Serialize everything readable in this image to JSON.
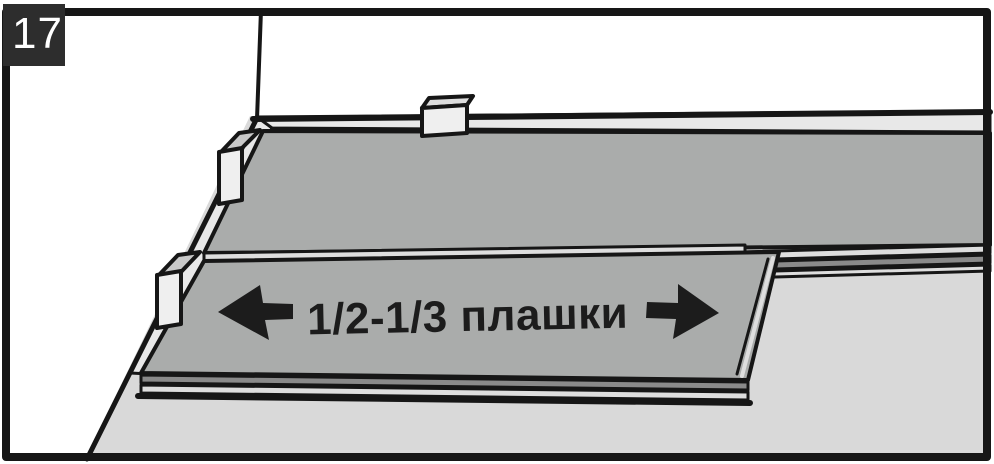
{
  "figure": {
    "step_number": "17",
    "label": "1/2-1/3 плашки",
    "description_icons": {
      "left": "arrow-left-icon",
      "right": "arrow-right-icon"
    }
  },
  "colors": {
    "badge_bg": "#2d2d2d",
    "badge_text": "#ffffff",
    "outline": "#161616",
    "wall": "#ffffff",
    "floor": "#d9d9d9",
    "plank": "#aaacab",
    "gap_strip": "#e8e8e8",
    "edge_dark": "#8a8a8a",
    "edge_light": "#dedede",
    "spacer_face": "#efefef",
    "spacer_top": "#c9c9c9",
    "label_color": "#1c1c1c"
  }
}
